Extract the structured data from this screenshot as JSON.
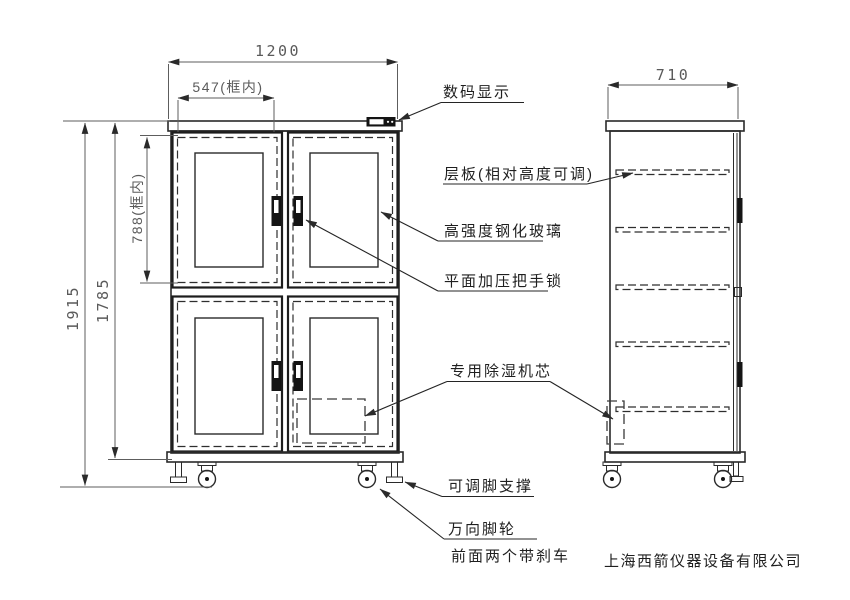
{
  "drawing": {
    "company": "上海西箭仪器设备有限公司",
    "dimensions": {
      "overall_width": "1200",
      "door_inner_width": "547(框内)",
      "door_inner_height": "788(框内)",
      "overall_height": "1915",
      "cabinet_height": "1785",
      "depth": "710"
    },
    "callouts": {
      "digital_display": "数码显示",
      "shelf": "层板(相对高度可调)",
      "tempered_glass": "高强度钢化玻璃",
      "handle_lock": "平面加压把手锁",
      "dehumidifier_core": "专用除湿机芯",
      "adjustable_foot": "可调脚支撑",
      "caster": "万向脚轮",
      "caster_note": "前面两个带刹车"
    },
    "colors": {
      "line": "#2a2a2a",
      "dim_line": "#5d5d5d",
      "background": "#ffffff"
    }
  }
}
